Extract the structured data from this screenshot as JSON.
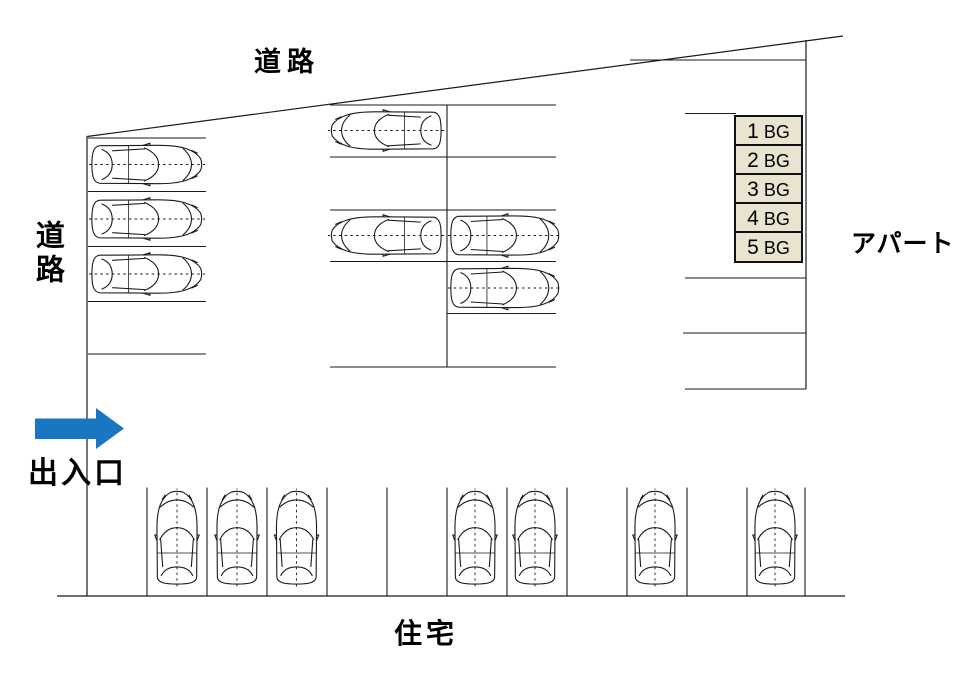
{
  "labels": {
    "road_top": "道路",
    "road_left": "道路",
    "apartment": "アパート",
    "entrance": "出入口",
    "residence": "住宅"
  },
  "bays": [
    {
      "number": "1",
      "code": "BG"
    },
    {
      "number": "2",
      "code": "BG"
    },
    {
      "number": "3",
      "code": "BG"
    },
    {
      "number": "4",
      "code": "BG"
    },
    {
      "number": "5",
      "code": "BG"
    }
  ],
  "colors": {
    "arrow_blue": "#1a76c2",
    "bay_box_fill": "#e9e4d0",
    "bay_box_border": "#111111",
    "diagram_line": "#1a1a1a"
  },
  "diagram": {
    "type": "parking-lot-map",
    "bay_label_count": 5,
    "bottom_row_slot_count": 11,
    "car_counts": {
      "left_column": 3,
      "middle_area": 4,
      "bottom_row": 7,
      "total": 14
    }
  }
}
